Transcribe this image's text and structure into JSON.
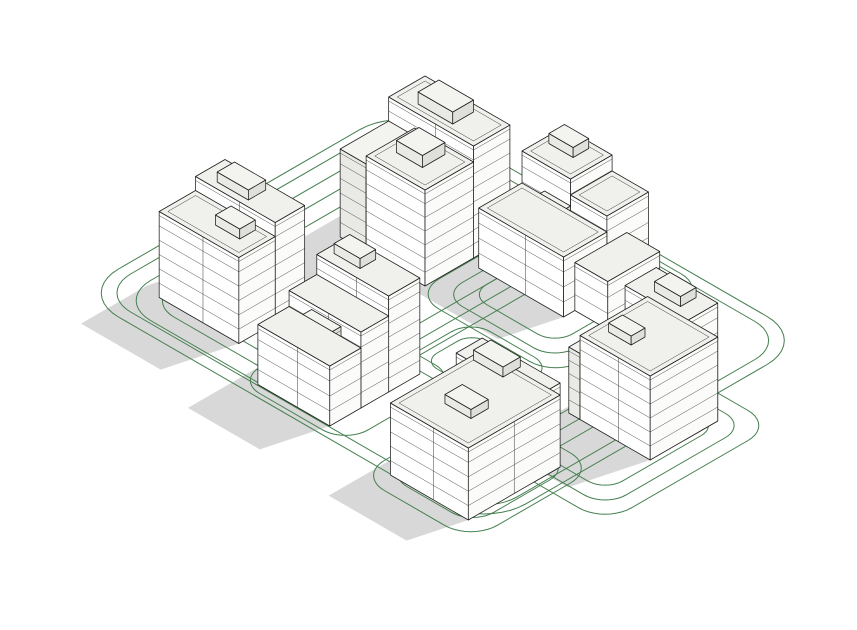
{
  "scene": {
    "canvas": {
      "width": 857,
      "height": 630,
      "background": "#ffffff"
    },
    "projection": {
      "cx": 380,
      "cy": 118,
      "ux": 0.866,
      "uy": 0.5
    },
    "sun": {
      "du_per_h": -0.2,
      "dv_per_h": 0.75
    },
    "colors": {
      "outline": "#1d1d1d",
      "floor_line": "#3a3a3a",
      "face_sw": "#ffffff",
      "face_se": "#fbfbf9",
      "face_sw_shaded": "#e9e9e6",
      "face_se_shaded": "#dfdfdb",
      "roof": "#f0f0ec",
      "roof_shaded": "#f3f3f0",
      "shadow": "#d8d8d8",
      "contour": "#447f4f"
    },
    "contours": [
      {
        "u": 0,
        "v": -25,
        "w": 470,
        "d": 375,
        "r": 48
      },
      {
        "u": 12,
        "v": -13,
        "w": 446,
        "d": 351,
        "r": 38
      },
      {
        "u": 30,
        "v": 5,
        "w": 230,
        "d": 330,
        "r": 40
      },
      {
        "u": 48,
        "v": 22,
        "w": 196,
        "d": 296,
        "r": 32
      },
      {
        "u": 66,
        "v": 40,
        "w": 162,
        "d": 262,
        "r": 26
      },
      {
        "u": 195,
        "v": -18,
        "w": 165,
        "d": 175,
        "r": 30
      },
      {
        "u": 212,
        "v": -2,
        "w": 131,
        "d": 143,
        "r": 24
      },
      {
        "u": 228,
        "v": 12,
        "w": 99,
        "d": 113,
        "r": 20
      },
      {
        "u": 400,
        "v": 80,
        "w": 135,
        "d": 195,
        "r": 30
      },
      {
        "u": 416,
        "v": 96,
        "w": 103,
        "d": 163,
        "r": 24
      },
      {
        "u": 432,
        "v": 112,
        "w": 71,
        "d": 131,
        "r": 20
      },
      {
        "u": 345,
        "v": 225,
        "w": 130,
        "d": 145,
        "r": 30
      },
      {
        "u": 360,
        "v": 240,
        "w": 100,
        "d": 113,
        "r": 24
      },
      {
        "u": 374,
        "v": 254,
        "w": 72,
        "d": 81,
        "r": 18
      },
      {
        "u": 180,
        "v": 215,
        "w": 125,
        "d": 130,
        "r": 26
      },
      {
        "u": 255,
        "v": 150,
        "w": 95,
        "d": 80,
        "r": 22
      },
      {
        "u": 268,
        "v": 162,
        "w": 69,
        "d": 56,
        "r": 16
      }
    ],
    "buildings": [
      {
        "name": "building-north",
        "shadow": {
          "u": 96,
          "v": 44,
          "w": 98,
          "d": 98,
          "h": 105
        },
        "boxes": [
          {
            "u": 96,
            "v": 44,
            "w": 98,
            "d": 42,
            "h": 112,
            "st": 8
          },
          {
            "u": 96,
            "v": 86,
            "w": 30,
            "d": 56,
            "h": 88,
            "st": 6,
            "shade": true
          },
          {
            "u": 126,
            "v": 86,
            "w": 68,
            "d": 56,
            "h": 96,
            "st": 7
          },
          {
            "u": 120,
            "v": 52,
            "w": 40,
            "d": 24,
            "h": 12,
            "z0": 112
          },
          {
            "u": 140,
            "v": 95,
            "w": 30,
            "d": 26,
            "h": 12,
            "z0": 96
          }
        ]
      },
      {
        "name": "building-northeast",
        "shadow": {
          "u": 207,
          "v": -5,
          "w": 98,
          "d": 98,
          "h": 80
        },
        "boxes": [
          {
            "u": 207,
            "v": -5,
            "w": 56,
            "d": 48,
            "h": 92,
            "st": 6
          },
          {
            "u": 263,
            "v": -5,
            "w": 42,
            "d": 48,
            "h": 76,
            "st": 5
          },
          {
            "u": 240,
            "v": 50,
            "w": 30,
            "d": 26,
            "h": 72,
            "st": 5,
            "shade": true
          },
          {
            "u": 207,
            "v": 43,
            "w": 98,
            "d": 50,
            "h": 60,
            "st": 4
          },
          {
            "u": 305,
            "v": 20,
            "w": 38,
            "d": 60,
            "h": 48,
            "st": 3
          },
          {
            "u": 215,
            "v": 2,
            "w": 28,
            "d": 18,
            "h": 10,
            "z0": 92
          }
        ]
      },
      {
        "name": "building-west",
        "shadow": {
          "u": 52,
          "v": 231,
          "w": 92,
          "d": 76,
          "h": 95
        },
        "boxes": [
          {
            "u": 52,
            "v": 231,
            "w": 92,
            "d": 34,
            "h": 100,
            "st": 7
          },
          {
            "u": 52,
            "v": 265,
            "w": 92,
            "d": 42,
            "h": 86,
            "st": 6
          },
          {
            "u": 70,
            "v": 238,
            "w": 36,
            "d": 20,
            "h": 10,
            "z0": 100
          },
          {
            "u": 98,
            "v": 270,
            "w": 28,
            "d": 18,
            "h": 10,
            "z0": 86
          }
        ]
      },
      {
        "name": "building-east",
        "shadow": {
          "u": 417,
          "v": 108,
          "w": 81,
          "d": 78,
          "h": 100
        },
        "boxes": [
          {
            "u": 427,
            "v": 108,
            "w": 71,
            "d": 36,
            "h": 118,
            "st": 8
          },
          {
            "u": 404,
            "v": 132,
            "w": 13,
            "d": 54,
            "h": 66,
            "st": 5,
            "shade": true
          },
          {
            "u": 417,
            "v": 108,
            "w": 81,
            "d": 78,
            "h": 84,
            "st": 6
          },
          {
            "u": 450,
            "v": 115,
            "w": 30,
            "d": 18,
            "h": 10,
            "z0": 118
          },
          {
            "u": 430,
            "v": 150,
            "w": 26,
            "d": 16,
            "h": 9,
            "z0": 84
          }
        ]
      },
      {
        "name": "building-center",
        "shadow": {
          "u": 196,
          "v": 233,
          "w": 83,
          "d": 104,
          "h": 85
        },
        "boxes": [
          {
            "u": 196,
            "v": 233,
            "w": 83,
            "d": 36,
            "h": 96,
            "st": 7
          },
          {
            "u": 196,
            "v": 269,
            "w": 83,
            "d": 32,
            "h": 76,
            "st": 5
          },
          {
            "u": 226,
            "v": 305,
            "w": 34,
            "d": 26,
            "h": 74,
            "st": 5,
            "shade": true
          },
          {
            "u": 196,
            "v": 301,
            "w": 83,
            "d": 36,
            "h": 60,
            "st": 4
          },
          {
            "u": 205,
            "v": 240,
            "w": 30,
            "d": 18,
            "h": 10,
            "z0": 96
          }
        ]
      },
      {
        "name": "building-south",
        "shadow": {
          "u": 363,
          "v": 245,
          "w": 90,
          "d": 106,
          "h": 75
        },
        "boxes": [
          {
            "u": 363,
            "v": 245,
            "w": 90,
            "d": 30,
            "h": 84,
            "st": 6
          },
          {
            "u": 363,
            "v": 245,
            "w": 90,
            "d": 106,
            "h": 72,
            "st": 5
          },
          {
            "u": 380,
            "v": 252,
            "w": 34,
            "d": 20,
            "h": 10,
            "z0": 84
          },
          {
            "u": 395,
            "v": 300,
            "w": 30,
            "d": 20,
            "h": 9,
            "z0": 72
          }
        ]
      }
    ]
  }
}
